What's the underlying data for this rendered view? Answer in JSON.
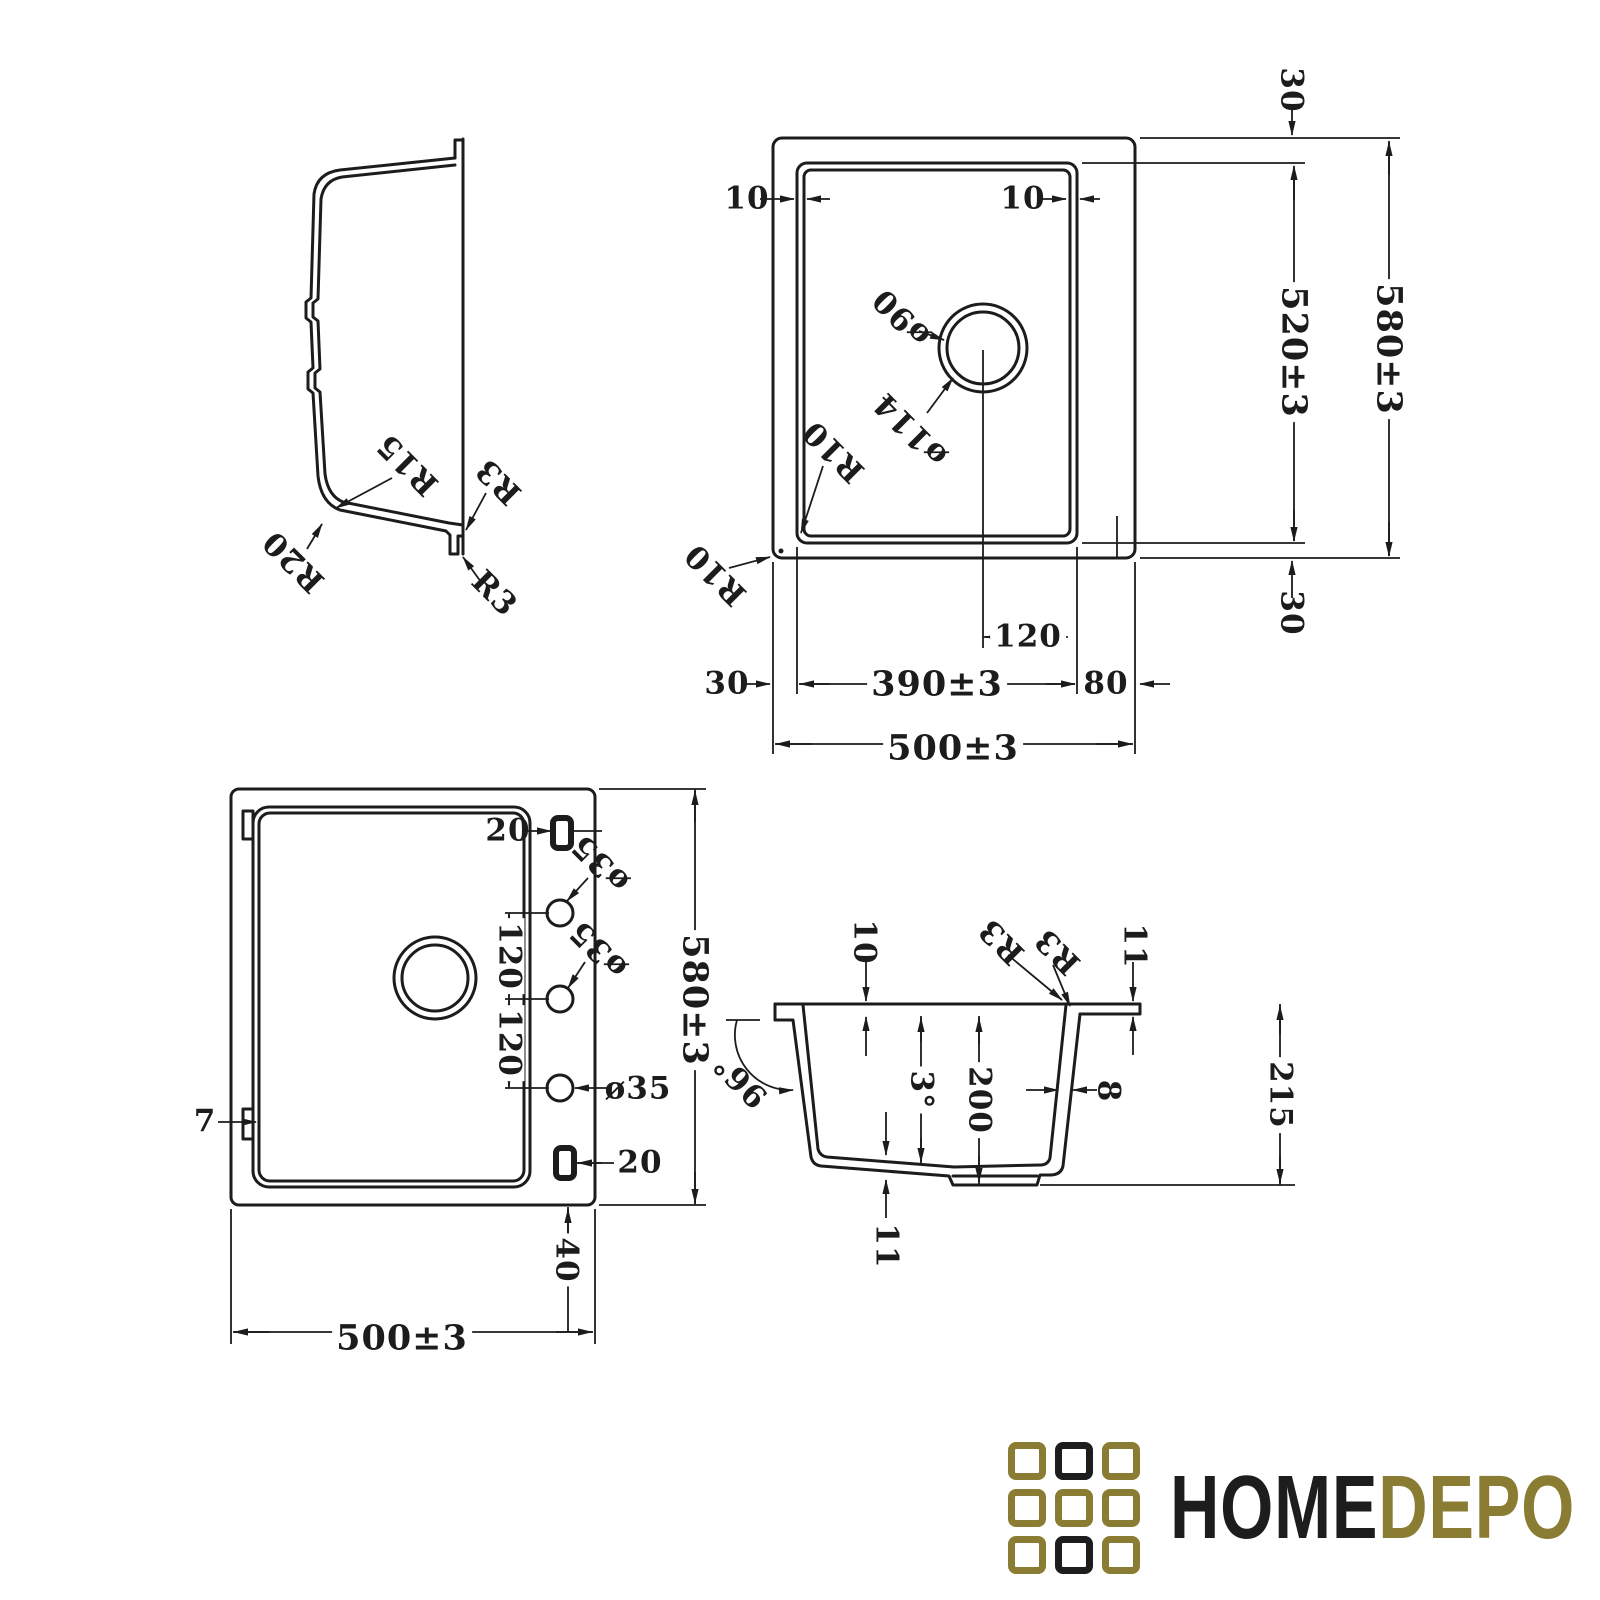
{
  "colors": {
    "line": "#1c1c1c",
    "logo_gold": "#8a7c33",
    "logo_black": "#1d1d1d",
    "background": "#ffffff"
  },
  "labels": {
    "profile": {
      "r15": "R15",
      "r20": "R20",
      "r3_top": "R3",
      "r3_bottom": "R3"
    },
    "top": {
      "gap_left": "10",
      "gap_right": "10",
      "offset_top": "30",
      "inner_height": "520±3",
      "outer_height": "580±3",
      "offset_bottom": "30",
      "drain_offset": "120",
      "inner_width": "390±3",
      "ledge_width": "80",
      "offset_left": "30",
      "outer_width": "500±3",
      "drain_dia_inner": "ø90",
      "drain_dia_outer": "ø114",
      "radius_bowl": "R10",
      "radius_corner": "R10"
    },
    "bottom": {
      "slot_top": "20",
      "hole_dia_1": "ø35",
      "hole_dia_2": "ø35",
      "hole_dia_3": "ø35",
      "hole_pitch_1": "120",
      "hole_pitch_2": "120",
      "overall_height": "580±3",
      "clip_width": "7",
      "slot_bottom": "20",
      "foot_offset": "40",
      "overall_width": "500±3"
    },
    "section": {
      "rim_thickness": "10",
      "radius_a": "R3",
      "radius_b": "R3",
      "edge_height": "11",
      "wall_angle": "96°",
      "floor_angle": "3°",
      "bowl_depth": "200",
      "wall_thickness": "8",
      "total_height": "215",
      "floor_thickness": "11"
    }
  },
  "logo": {
    "home": "HOME",
    "depo": "DEPO",
    "grid": [
      "gold",
      "black",
      "gold",
      "gold",
      "gold",
      "gold",
      "gold",
      "black",
      "gold"
    ]
  }
}
